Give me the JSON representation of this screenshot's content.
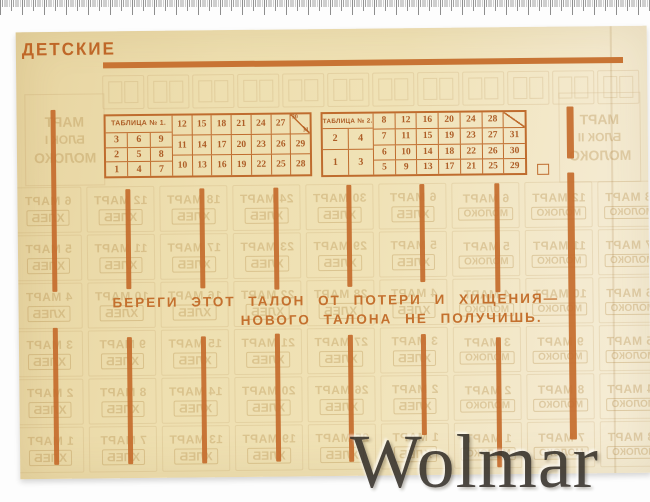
{
  "sheet": {
    "title": "ДЕТСКИЕ"
  },
  "slogan": {
    "line1": "БЕРЕГИ ЭТОТ ТАЛОН ОТ ПОТЕРИ И ХИЩЕНИЯ—",
    "line2": "НОВОГО ТАЛОНА НЕ ПОЛУЧИШЬ."
  },
  "watermark": {
    "text": "Wolmar"
  },
  "tables": [
    {
      "title": "ТАБЛИЦА № 1.",
      "left_rows": [
        [
          "3",
          "6",
          "9"
        ],
        [
          "2",
          "5",
          "8"
        ],
        [
          "1",
          "4",
          "7"
        ]
      ],
      "right_rows": [
        [
          "12",
          "15",
          "18",
          "21",
          "24",
          "27",
          "30/31"
        ],
        [
          "11",
          "14",
          "17",
          "20",
          "23",
          "26",
          "29"
        ],
        [
          "10",
          "13",
          "16",
          "19",
          "22",
          "25",
          "28"
        ]
      ]
    },
    {
      "title": "ТАБЛИЦА № 2.",
      "left_rows": [
        [
          "2",
          "4"
        ],
        [
          "1",
          "3"
        ]
      ],
      "right_rows": [
        [
          "8",
          "12",
          "16",
          "20",
          "24",
          "28",
          "/"
        ],
        [
          "7",
          "11",
          "15",
          "19",
          "23",
          "27",
          "31"
        ],
        [
          "6",
          "10",
          "14",
          "18",
          "22",
          "26",
          "30"
        ],
        [
          "5",
          "9",
          "13",
          "17",
          "21",
          "25",
          "29"
        ]
      ]
    }
  ],
  "ghost": {
    "month": "МАРТ",
    "bread": "ХЛЕБ",
    "milk": "МОЛОКО",
    "left_stamp": [
      "МАРТ",
      "БЛОК I",
      "МОЛОКО"
    ],
    "right_stamp": [
      "МАРТ",
      "БЛОК II",
      "МОЛОКО"
    ]
  },
  "colors": {
    "ink": "#bf6c2e",
    "bars": "#c56d2d",
    "paper": "#eedfb0",
    "ghost": "#b9925a",
    "watermark": "#3a352e",
    "ruler": "#a0a0a0"
  },
  "decor": {
    "bars": [
      {
        "x": 34,
        "w": 5,
        "segments": [
          [
            78,
            260
          ],
          [
            296,
            433
          ]
        ]
      },
      {
        "x": 108,
        "w": 5,
        "segments": [
          [
            158,
            258
          ],
          [
            306,
            433
          ]
        ]
      },
      {
        "x": 182,
        "w": 5,
        "segments": [
          [
            158,
            258
          ],
          [
            306,
            433
          ]
        ]
      },
      {
        "x": 256,
        "w": 5,
        "segments": [
          [
            158,
            260
          ],
          [
            304,
            432
          ]
        ]
      },
      {
        "x": 329,
        "w": 5,
        "segments": [
          [
            156,
            258
          ],
          [
            306,
            433
          ]
        ]
      },
      {
        "x": 402,
        "w": 5,
        "segments": [
          [
            156,
            254
          ],
          [
            306,
            407
          ]
        ]
      },
      {
        "x": 477,
        "w": 5,
        "segments": [
          [
            156,
            265
          ],
          [
            310,
            440
          ]
        ]
      },
      {
        "x": 550,
        "w": 7,
        "segments": [
          [
            80,
            132
          ],
          [
            146,
            413
          ]
        ]
      }
    ]
  }
}
